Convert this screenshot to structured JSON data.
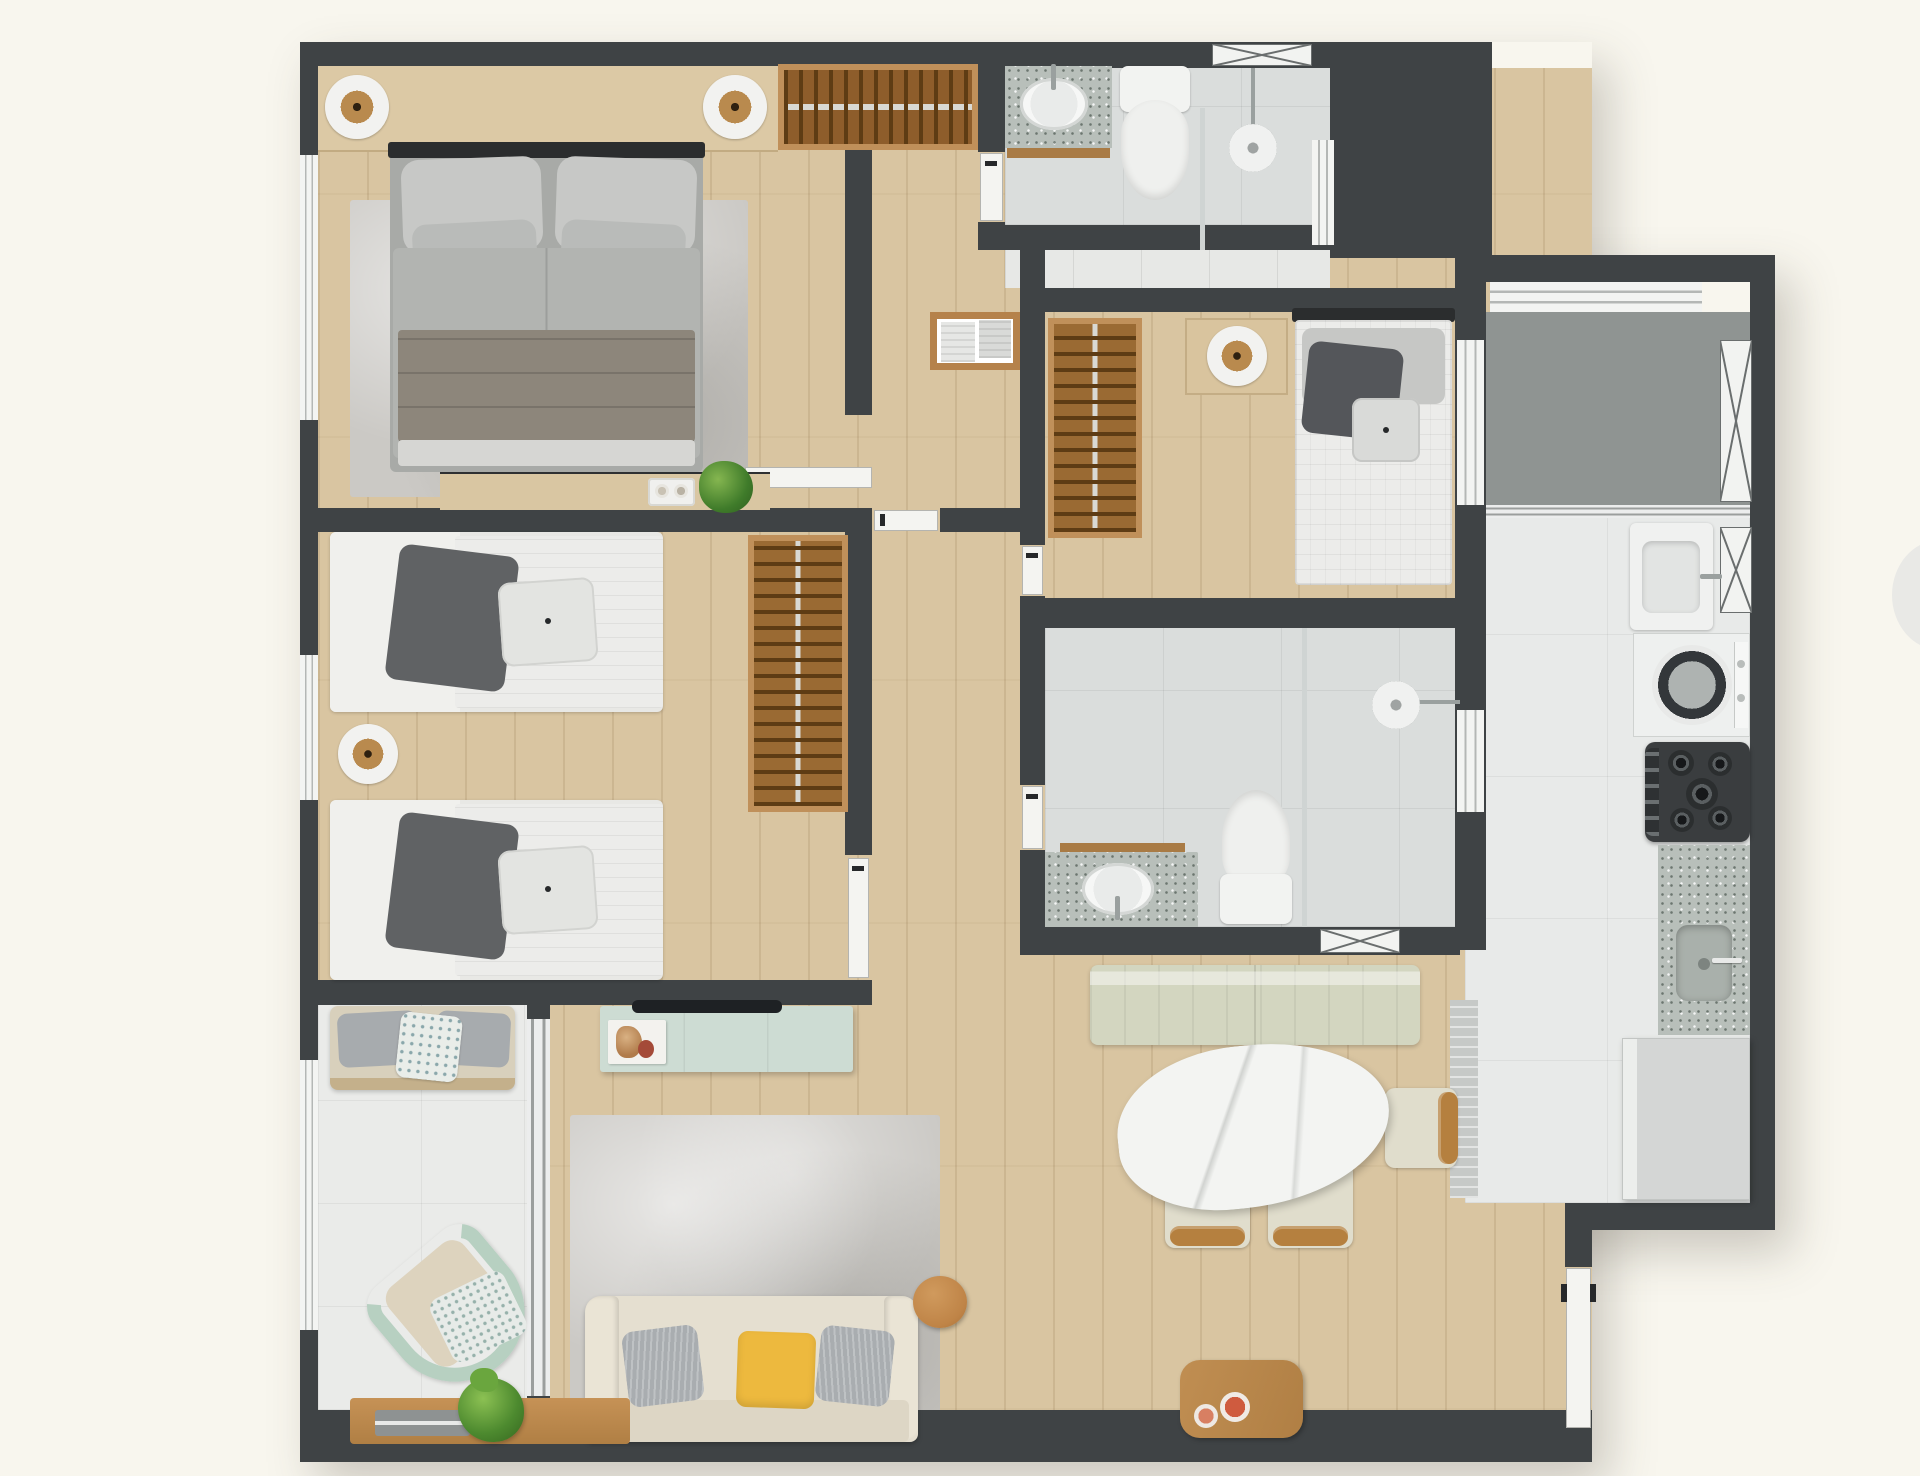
{
  "title": "Apartment floor plan - furnished top-down 3D render",
  "palette": {
    "wall": "#3f4345",
    "floor_wood": "#d9c5a1",
    "tile_bath": "#dadddc",
    "tile_kitchen": "#e8eae9",
    "tile_balcony": "#eaebe9",
    "service_floor": "#8f9492",
    "granite": "#b8bfba",
    "wood_furniture": "#c0905a",
    "wood_dark": "#8e5d2b",
    "mint_sideboard": "#cddcd3",
    "sofa_cream": "#e5dfd0",
    "pillow_yellow": "#edb93e",
    "pillow_gray": "#a9adb0",
    "bench_sage": "#d3d6c0",
    "marble_white": "#f3f4f2",
    "fixture_white": "#f2f3f1",
    "rattan_mint": "#b7d0c1",
    "plant_green": "#4d8a2f",
    "dish_red": "#cf5b3f"
  },
  "rooms": [
    {
      "id": "master-bedroom",
      "label": "Master bedroom",
      "floor": "wood"
    },
    {
      "id": "twin-bedroom",
      "label": "Twin bedroom",
      "floor": "wood"
    },
    {
      "id": "bedroom-3",
      "label": "Single bedroom",
      "floor": "wood"
    },
    {
      "id": "bathroom-1",
      "label": "Suite bathroom",
      "floor": "gray tile"
    },
    {
      "id": "bathroom-2",
      "label": "Social bathroom",
      "floor": "gray tile"
    },
    {
      "id": "hallway",
      "label": "Hallway",
      "floor": "wood"
    },
    {
      "id": "living-room",
      "label": "Living room",
      "floor": "wood"
    },
    {
      "id": "dining-area",
      "label": "Dining area",
      "floor": "wood"
    },
    {
      "id": "kitchen",
      "label": "Kitchen",
      "floor": "white tile"
    },
    {
      "id": "service-area",
      "label": "Service area",
      "floor": "gray"
    },
    {
      "id": "balcony",
      "label": "Balcony",
      "floor": "white tile"
    }
  ],
  "furniture": {
    "master_bedroom": [
      "double bed",
      "two round lamps on headboard shelf",
      "open wardrobe with hangers",
      "area rug",
      "dresser with perfume tray and plant"
    ],
    "twin_bedroom": [
      "two single beds",
      "round bedside lamp",
      "open wardrobe with hangers",
      "window"
    ],
    "bedroom_3": [
      "single bed",
      "nightstand with lamp",
      "open wardrobe with hangers"
    ],
    "bathroom_1": [
      "granite vanity with oval sink",
      "toilet",
      "glass shower with shower head",
      "x-vent window"
    ],
    "bathroom_2": [
      "granite vanity with oval sink",
      "toilet",
      "glass shower with shower head",
      "x-vent window"
    ],
    "hallway": [
      "wall shelf with towels"
    ],
    "living_room": [
      "mint TV sideboard with TV and magazine",
      "gray rug",
      "cream sofa with gray and yellow pillows",
      "round wood side table",
      "wood coffee table with two dishes"
    ],
    "dining_area": [
      "sage banquette bench",
      "oval marble dining table",
      "three wood chairs"
    ],
    "kitchen": [
      "laundry tub",
      "washing machine",
      "gas stove",
      "granite counter with sink",
      "refrigerator",
      "runner rug"
    ],
    "balcony": [
      "bench with cushions",
      "rattan armchair",
      "potted plant",
      "low wood shelf with tray"
    ]
  }
}
